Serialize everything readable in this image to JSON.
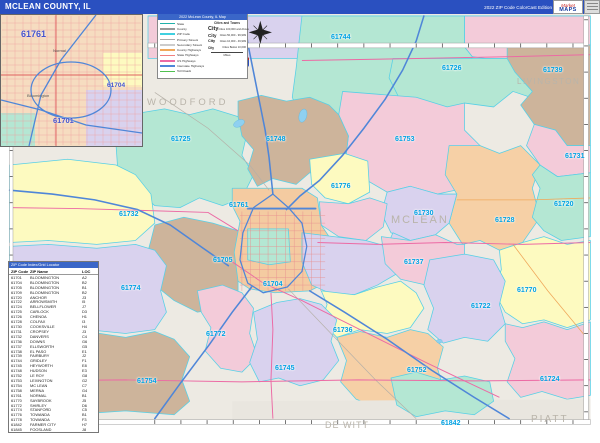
{
  "colors": {
    "titlebar": "#2a50c0",
    "legendbar": "#3a66c8",
    "zip_label": "#00a2e4",
    "inset_label": "#4553cc",
    "county_label": "#b9b4aa",
    "interstate": "#4f86d8",
    "us_highway": "#ec6aa4",
    "zip_boundary": "#58d0e6"
  },
  "title_bar": {
    "title": "MCLEAN COUNTY, IL",
    "edition": "2022 ZIP Code ColorCast Edition",
    "logo_line1": "Market",
    "logo_line2": "MAPS"
  },
  "legend": {
    "title": "2022 McLean County, IL Map",
    "left_items": [
      {
        "label": "State",
        "color": "#20b2aa"
      },
      {
        "label": "County",
        "color": "#999999"
      },
      {
        "label": "ZIP Code",
        "color": "#40d0e0"
      },
      {
        "label": "Primary Streets",
        "color": "#aaaaaa"
      },
      {
        "label": "Secondary Streets",
        "color": "#cccccc"
      },
      {
        "label": "County Highways",
        "color": "#f0a85a"
      },
      {
        "label": "State Highways",
        "color": "#f08080"
      },
      {
        "label": "US Highways",
        "color": "#ec6aa4"
      },
      {
        "label": "Interstate Highways",
        "color": "#4f86d8"
      },
      {
        "label": "Toll Roads",
        "color": "#50c050"
      }
    ],
    "cities_header": "Cities and Towns",
    "city_rows": [
      {
        "sample": "City",
        "size": 5.5,
        "label": "Cities 100,000 and Above"
      },
      {
        "sample": "City",
        "size": 4.5,
        "label": "Cities 50,000 - 99,999"
      },
      {
        "sample": "City",
        "size": 3.8,
        "label": "Cities 10,000 - 49,999"
      },
      {
        "sample": "City",
        "size": 3.2,
        "label": "Cities Below 10,000"
      }
    ],
    "scale_label": "Miles"
  },
  "compass": {
    "icon": "compass-rose-icon"
  },
  "interstate_shield": {
    "number": "39"
  },
  "inset": {
    "labels": [
      {
        "zip": "61761",
        "x": 20,
        "y": 14,
        "fs": 9
      },
      {
        "zip": "61704",
        "x": 106,
        "y": 67,
        "fs": 6.5
      },
      {
        "zip": "61701",
        "x": 52,
        "y": 101,
        "fs": 7.5
      }
    ],
    "cities": [
      {
        "name": "Normal",
        "x": 52,
        "y": 33
      },
      {
        "name": "Bloomington",
        "x": 26,
        "y": 78
      }
    ]
  },
  "map": {
    "county_labels": [
      {
        "name": "WOODFORD",
        "x": 147,
        "y": 97,
        "fs": 9.5,
        "ls": 3
      },
      {
        "name": "LIVINGSTON",
        "x": 517,
        "y": 77,
        "fs": 8,
        "ls": 1.5
      },
      {
        "name": "MCLEAN",
        "x": 391,
        "y": 214,
        "fs": 11,
        "ls": 2
      },
      {
        "name": "DE WITT",
        "x": 325,
        "y": 420,
        "fs": 9,
        "ls": 1
      },
      {
        "name": "PIATT",
        "x": 531,
        "y": 414,
        "fs": 10,
        "ls": 2
      }
    ],
    "zip_labels": [
      {
        "zip": "61744",
        "x": 345,
        "y": 38
      },
      {
        "zip": "61726",
        "x": 456,
        "y": 69
      },
      {
        "zip": "61739",
        "x": 557,
        "y": 71
      },
      {
        "zip": "61753",
        "x": 409,
        "y": 140
      },
      {
        "zip": "61725",
        "x": 185,
        "y": 140
      },
      {
        "zip": "61748",
        "x": 280,
        "y": 140
      },
      {
        "zip": "61731",
        "x": 579,
        "y": 157
      },
      {
        "zip": "61776",
        "x": 345,
        "y": 187
      },
      {
        "zip": "61720",
        "x": 568,
        "y": 205
      },
      {
        "zip": "61761",
        "x": 243,
        "y": 206
      },
      {
        "zip": "61730",
        "x": 428,
        "y": 214
      },
      {
        "zip": "61732",
        "x": 133,
        "y": 215
      },
      {
        "zip": "61728",
        "x": 509,
        "y": 221
      },
      {
        "zip": "61705",
        "x": 227,
        "y": 261
      },
      {
        "zip": "61737",
        "x": 418,
        "y": 263
      },
      {
        "zip": "61704",
        "x": 277,
        "y": 285
      },
      {
        "zip": "61774",
        "x": 135,
        "y": 289
      },
      {
        "zip": "61770",
        "x": 531,
        "y": 291
      },
      {
        "zip": "61722",
        "x": 485,
        "y": 307
      },
      {
        "zip": "61736",
        "x": 347,
        "y": 331
      },
      {
        "zip": "61772",
        "x": 220,
        "y": 335
      },
      {
        "zip": "61745",
        "x": 289,
        "y": 369
      },
      {
        "zip": "61752",
        "x": 421,
        "y": 371
      },
      {
        "zip": "61724",
        "x": 554,
        "y": 380
      },
      {
        "zip": "61754",
        "x": 151,
        "y": 382
      },
      {
        "zip": "61842",
        "x": 455,
        "y": 424
      }
    ]
  },
  "zip_table": {
    "title": "ZIP Code Index/Grid Locator",
    "columns": [
      "ZIP Code",
      "ZIP Name",
      "LOC"
    ],
    "rows": [
      [
        "61701",
        "BLOOMINGTON",
        "A2"
      ],
      [
        "61704",
        "BLOOMINGTON",
        "B2"
      ],
      [
        "61705",
        "BLOOMINGTON",
        "B1"
      ],
      [
        "61709",
        "BLOOMINGTON",
        "B2"
      ],
      [
        "61720",
        "ANCHOR",
        "J3"
      ],
      [
        "61722",
        "ARROWSMITH",
        "I5"
      ],
      [
        "61724",
        "BELLFLOWER",
        "J7"
      ],
      [
        "61725",
        "CARLOCK",
        "D3"
      ],
      [
        "61726",
        "CHENOA",
        "H1"
      ],
      [
        "61728",
        "COLFAX",
        "I3"
      ],
      [
        "61730",
        "COOKSVILLE",
        "H4"
      ],
      [
        "61731",
        "CROPSEY",
        "J3"
      ],
      [
        "61732",
        "DANVERS",
        "C4"
      ],
      [
        "61736",
        "DOWNS",
        "G6"
      ],
      [
        "61737",
        "ELLSWORTH",
        "G5"
      ],
      [
        "61738",
        "EL PASO",
        "E1"
      ],
      [
        "61739",
        "FAIRBURY",
        "J2"
      ],
      [
        "61744",
        "GRIDLEY",
        "F1"
      ],
      [
        "61745",
        "HEYWORTH",
        "E8"
      ],
      [
        "61748",
        "HUDSON",
        "E3"
      ],
      [
        "61752",
        "LE ROY",
        "G8"
      ],
      [
        "61753",
        "LEXINGTON",
        "G2"
      ],
      [
        "61754",
        "MC LEAN",
        "C7"
      ],
      [
        "61758",
        "MERNA",
        "G4"
      ],
      [
        "61761",
        "NORMAL",
        "B1"
      ],
      [
        "61770",
        "SAYBROOK",
        "J5"
      ],
      [
        "61772",
        "SHIRLEY",
        "D6"
      ],
      [
        "61774",
        "STANFORD",
        "C5"
      ],
      [
        "61776",
        "TOWANDA",
        "B1"
      ],
      [
        "61778",
        "TOWANDA",
        "F3"
      ],
      [
        "61842",
        "FARMER CITY",
        "H7"
      ],
      [
        "61845",
        "FOOSLAND",
        "J8"
      ]
    ]
  }
}
